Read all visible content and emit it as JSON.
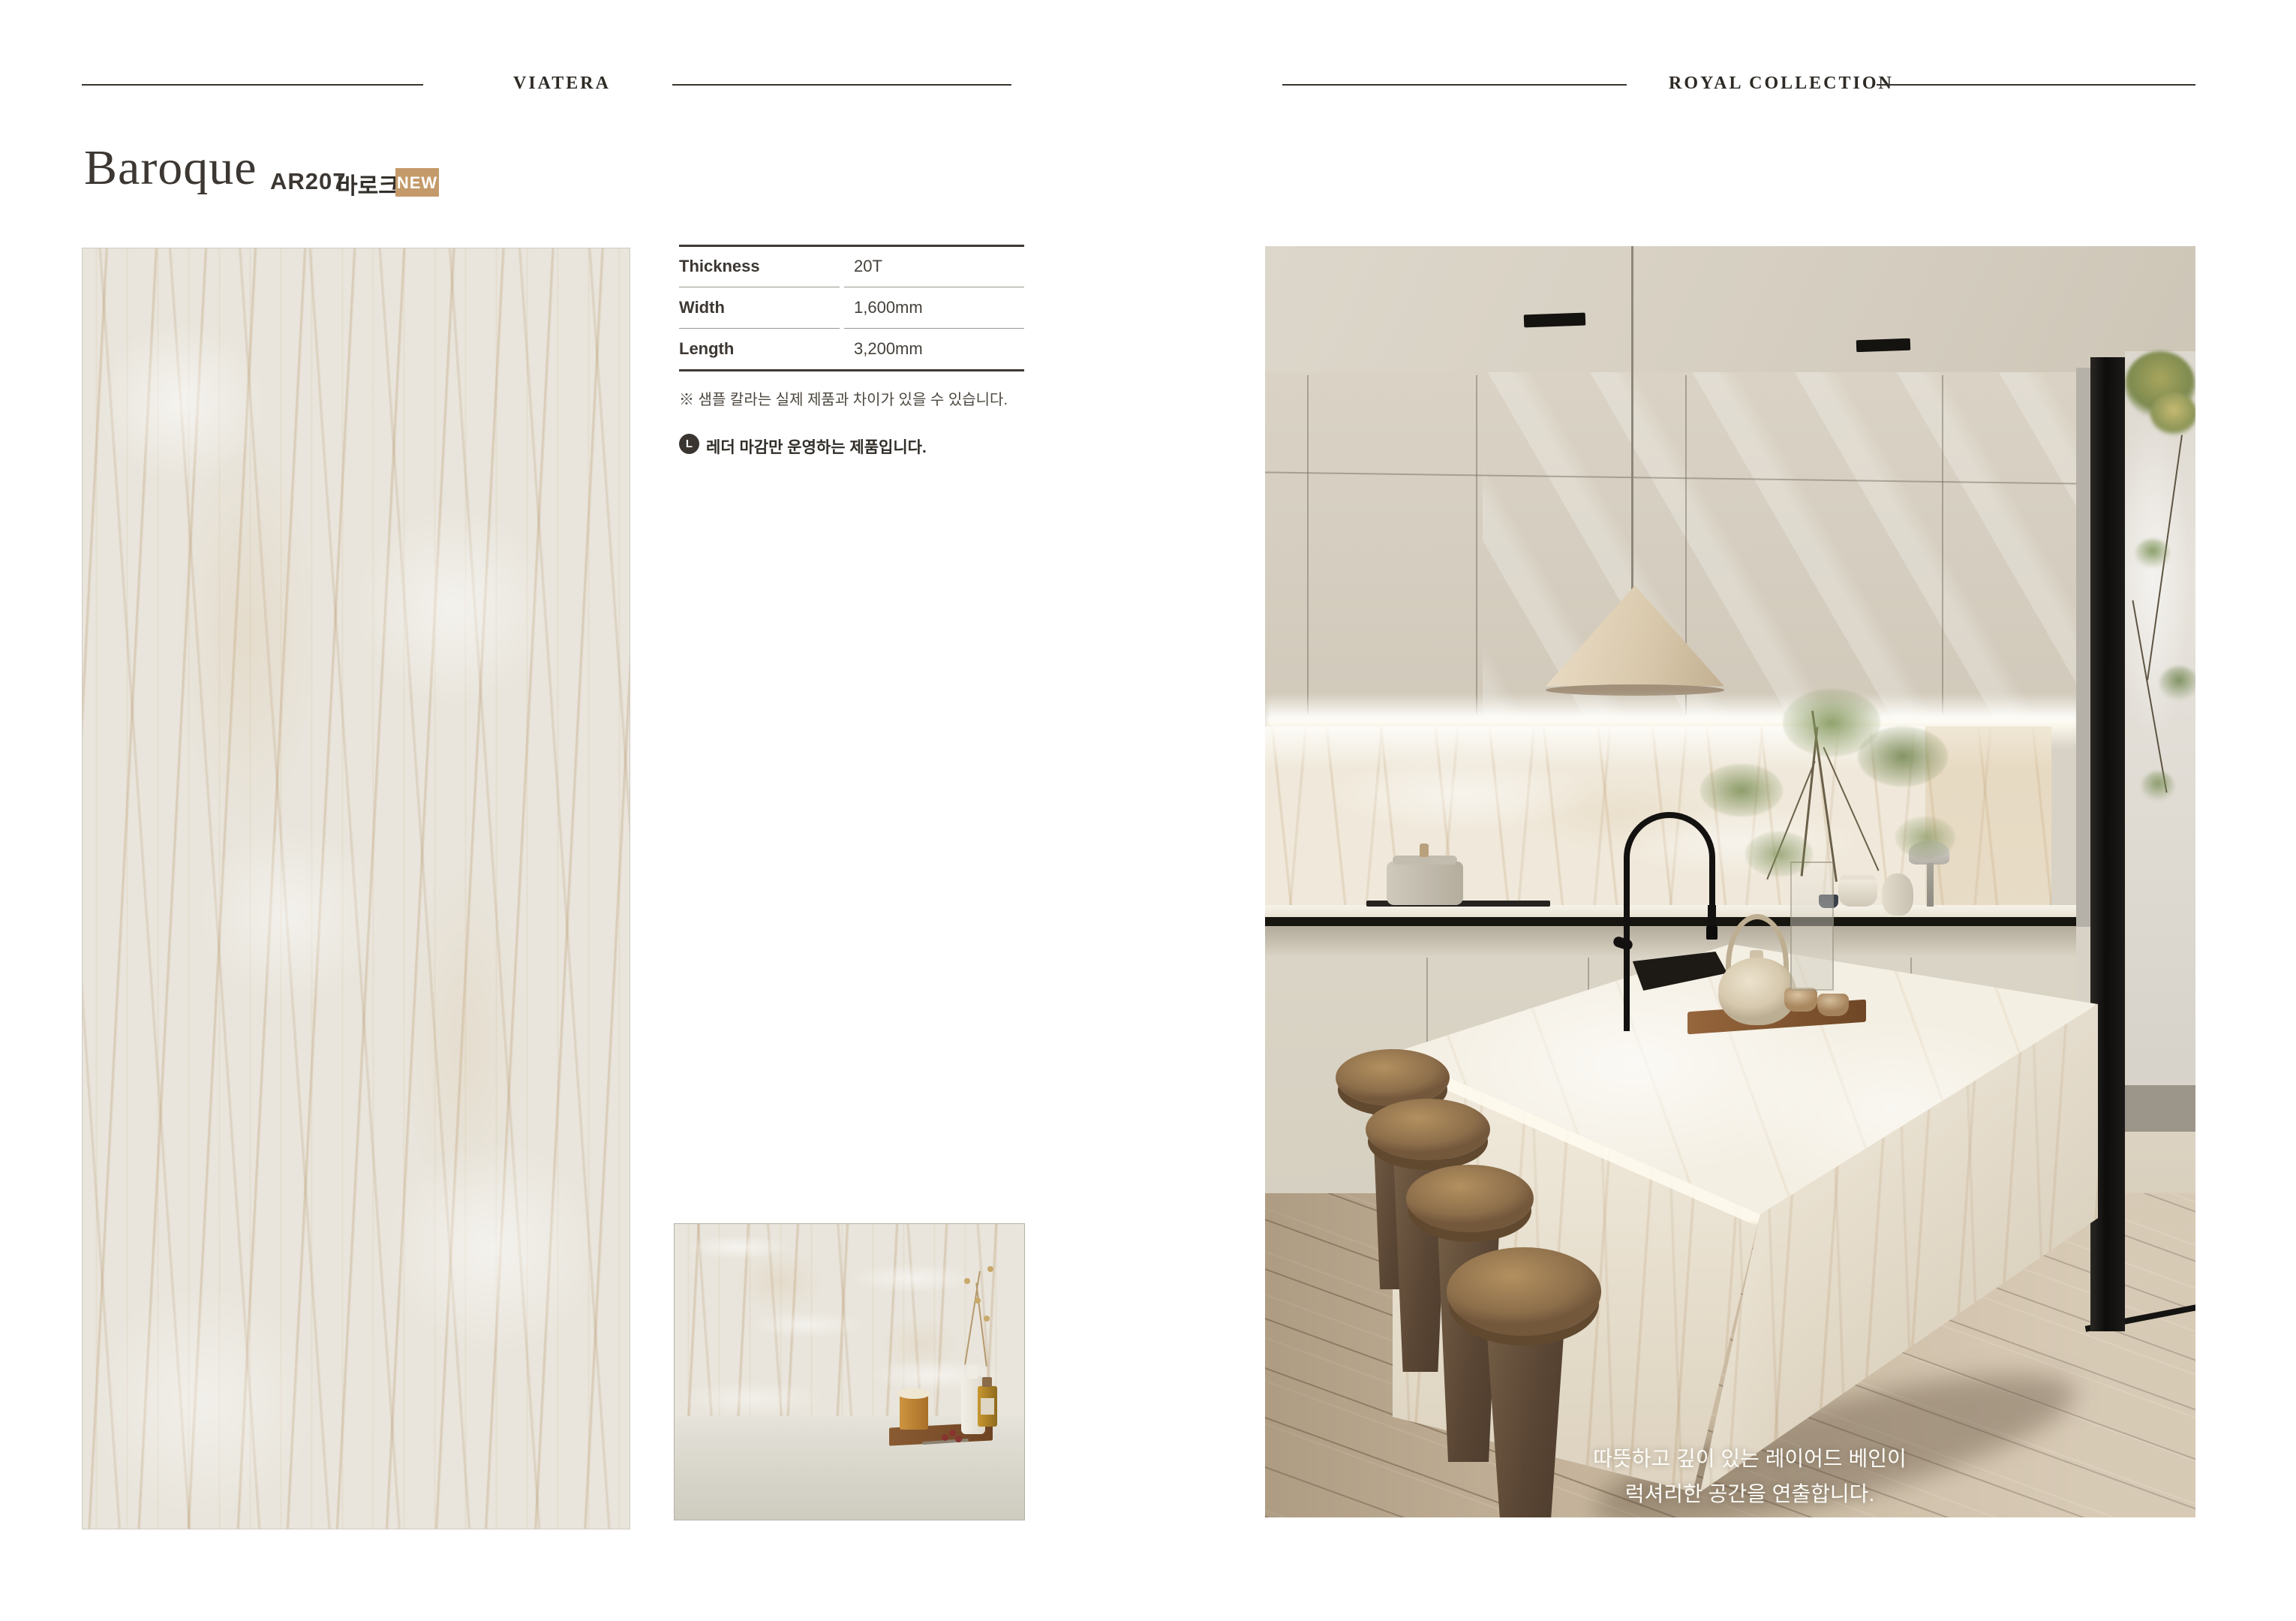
{
  "header_left": {
    "brand": "VIATERA"
  },
  "header_right": {
    "collection": "ROYAL COLLECTION"
  },
  "product": {
    "name": "Baroque",
    "code": "AR207",
    "korean_name": "바로크",
    "badge_new": "NEW"
  },
  "spec_table": {
    "rows": [
      {
        "label": "Thickness",
        "value": "20T"
      },
      {
        "label": "Width",
        "value": "1,600mm"
      },
      {
        "label": "Length",
        "value": "3,200mm"
      }
    ]
  },
  "notes": {
    "sample_note": "※ 샘플 칼라는 실제 제품과 차이가 있을 수 있습니다.",
    "finish_icon": "L",
    "finish_note": "레더 마감만 운영하는 제품입니다."
  },
  "kitchen_photo": {
    "caption_line1": "따뜻하고 깊이 있는 레이어드 베인이",
    "caption_line2": "럭셔리한 공간을 연출합니다."
  },
  "colors": {
    "badge_bg": "#c49a6a",
    "text_dark": "#3c3732",
    "rule_dark": "#3a352f",
    "marble_vein": "#c3a477"
  }
}
